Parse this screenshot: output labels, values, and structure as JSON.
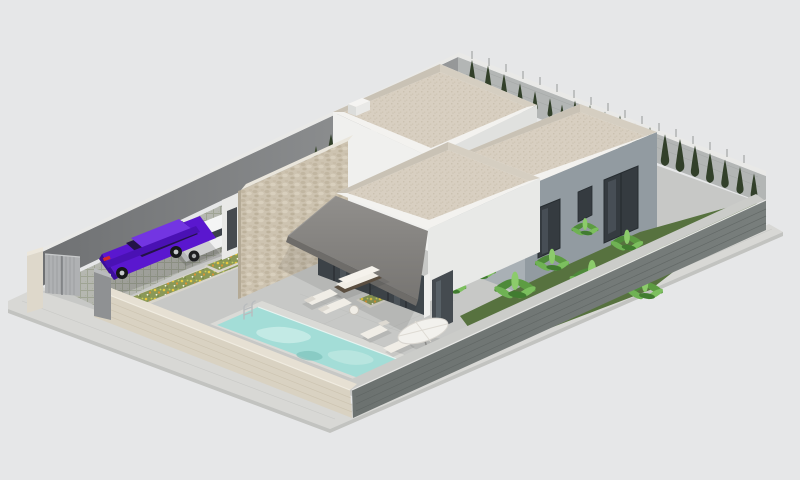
{
  "meta": {
    "type": "3d-architectural-render",
    "view": "isometric aerial",
    "description": "Isometric 3D rendering of a modern single-storey villa on a walled plot with flat roofs, stone feature wall, covered terrace, swimming pool, sun loungers, parasol, two parked cars, flower beds, banana plants and a cypress hedge."
  },
  "objects": {
    "villa": {
      "label": "modern flat-roof villa",
      "volumes": 3,
      "features": [
        "white walls",
        "grey wing",
        "stone-clad feature wall",
        "dark awning",
        "glass sliding doors",
        "roof chimney"
      ]
    },
    "pool": {
      "label": "rectangular swimming pool",
      "features": [
        "chrome ladder",
        "light coping"
      ]
    },
    "cars": [
      {
        "label": "purple sedan"
      },
      {
        "label": "white SUV"
      }
    ],
    "terrace": {
      "furniture": [
        "outdoor sofa",
        "double loungers",
        "coffee table",
        "three poolside loungers",
        "white parasol"
      ]
    },
    "garden": {
      "plants": [
        "cypress hedge",
        "banana plants",
        "two flower beds",
        "entry shrubs"
      ]
    },
    "boundary": {
      "features": [
        "grey driveway gate",
        "corner pillars",
        "beige brick front wall",
        "dark grey side wall",
        "inner grey walls",
        "perimeter sidewalk",
        "grass-grid parking pavers"
      ]
    }
  },
  "palette": {
    "background": "#e6e7e8",
    "sidewalk": "#d8d8d5",
    "pavement": "#c7c8c6",
    "pavers": "#b5b7b0",
    "wall_front_beige": "#d9d2c2",
    "wall_right_dark": "#717775",
    "wall_rear_inner": "#7b7d7f",
    "wall_right_inner": "#b3b6b5",
    "wall_cap": "#e9e9e7",
    "wall_top_face": "#cbccc9",
    "gate": "#afb1b3",
    "pillar_beige": "#ded8cb",
    "pillar_grey": "#8f9193",
    "roof_deck": "#d8cfc1",
    "parapet": "#f3f2ef",
    "house_white": "#f0f0ee",
    "house_white_shaded": "#e8e9e7",
    "house_grey": "#929ba1",
    "house_grey_light": "#a9b0b5",
    "stone": "#cdc3b0",
    "awning": "#8a8885",
    "awning_fascia": "#6e6c69",
    "glass": "#3f464b",
    "window": "#353b40",
    "pool_water": "#a3ddd7",
    "pool_coping": "#dadad6",
    "garden_green": "#57723f",
    "cypress": "#32402a",
    "banana_light": "#7cbf5e",
    "banana_dark": "#4e8a3a",
    "flowerbed": "#8a9857",
    "flower_yellow": "#e8c83f",
    "flower_orange": "#dd9434",
    "car_purple": "#5a17cf",
    "car_purple_dark": "#3c0d9c",
    "car_window": "#241347",
    "car_white": "#eff0f0",
    "furniture_white": "#f0ede6",
    "furniture_frame": "#5a4e40"
  }
}
